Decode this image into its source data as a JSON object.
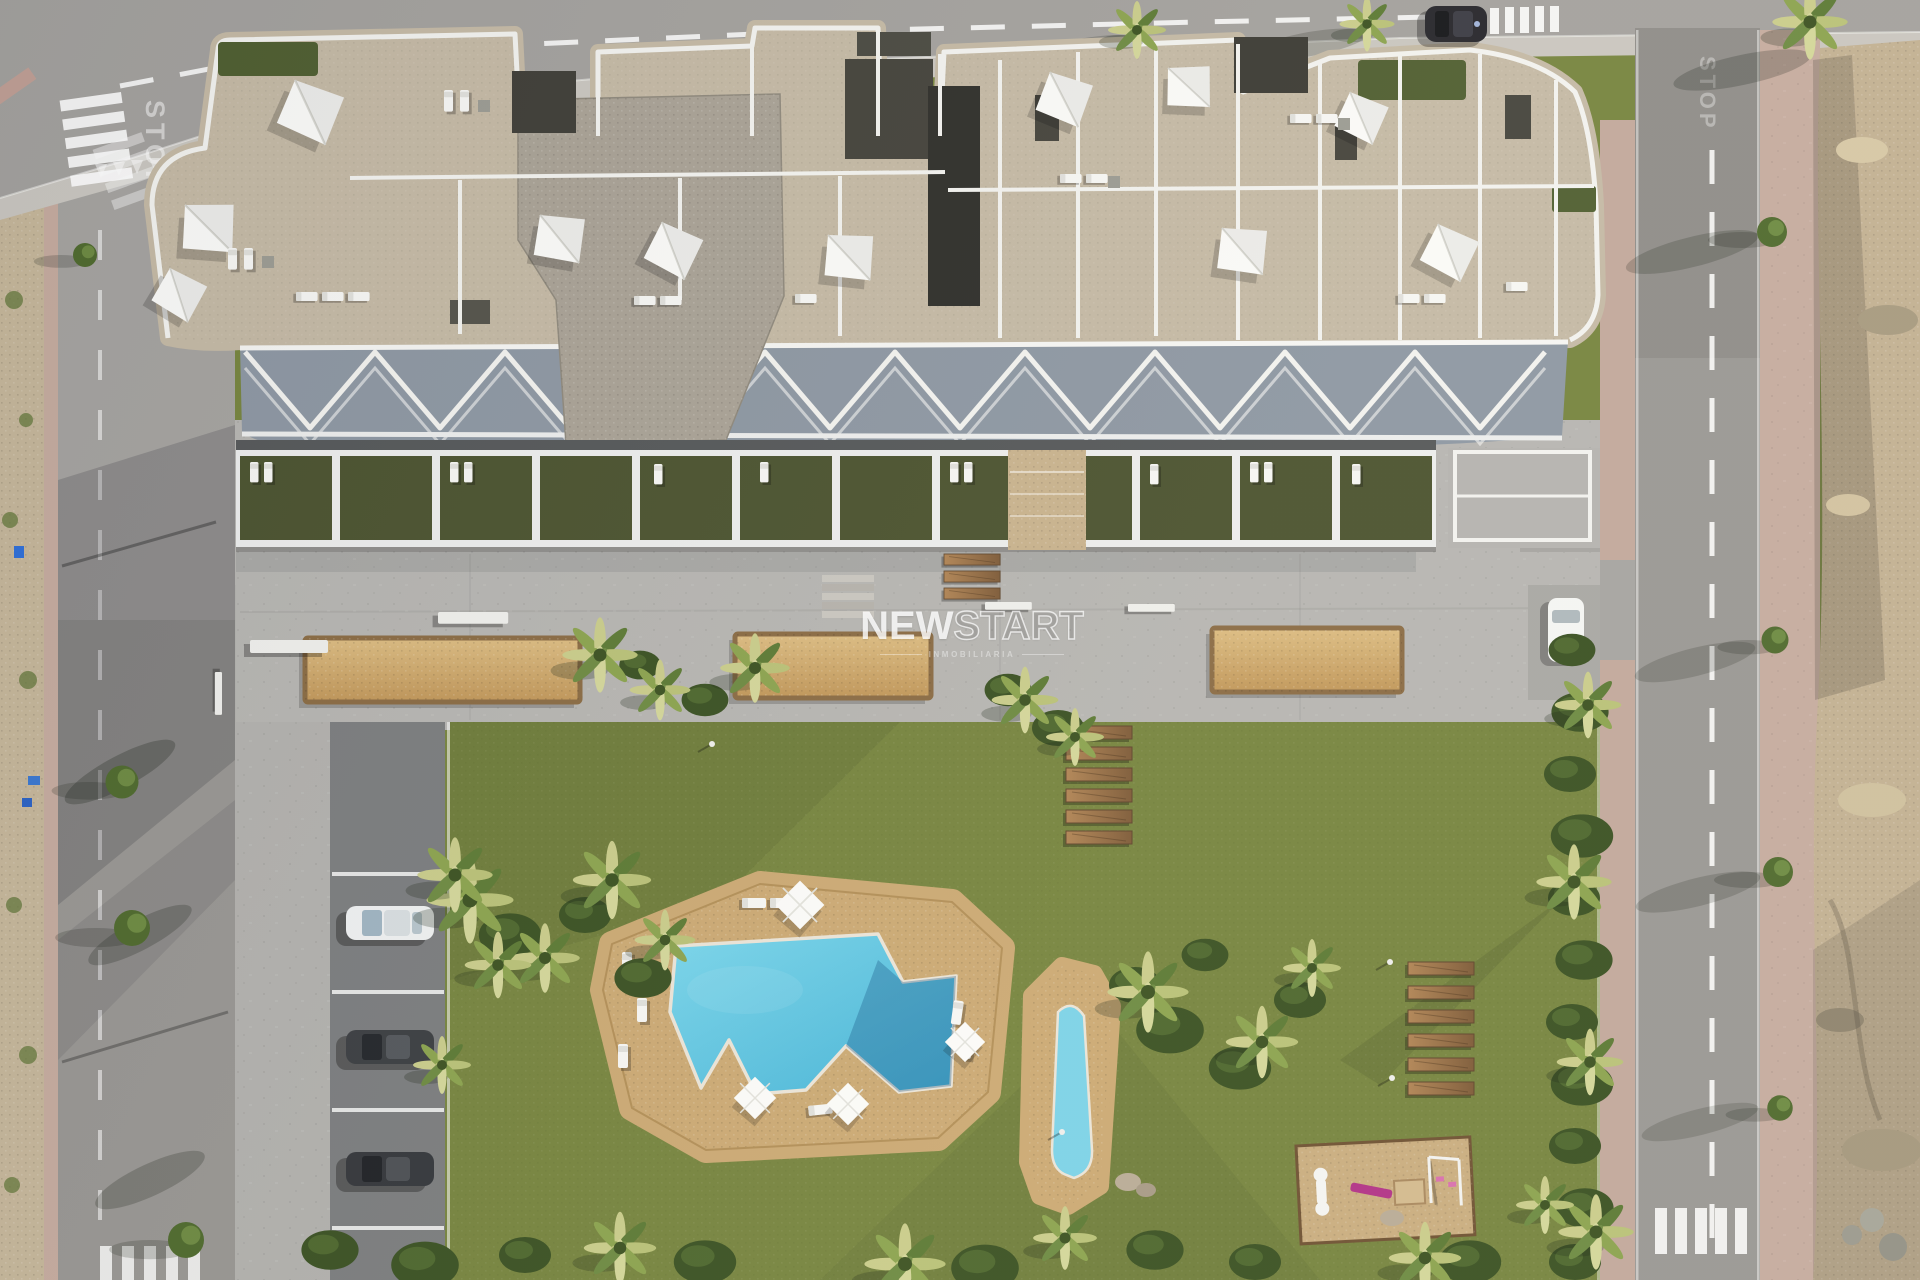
{
  "watermark": {
    "brand_bold": "NEW",
    "brand_outline": "START",
    "tagline": "INMOBILIARIA"
  },
  "road_markings": {
    "stop_left": "STOP",
    "stop_right": "STOP"
  },
  "palette": {
    "road": "#a3a19e",
    "road_dark": "#8f8d8a",
    "sidewalk": "#c9c6c0",
    "sidewalk_pink": "#c5ab9f",
    "dirt_lot": "#c2b093",
    "lawn": "#76843f",
    "terrace_lawn": "#4b5330",
    "promenade_concrete": "#b6b5b2",
    "planter_sand": "#d0ab6e",
    "pool_deck": "#cba974",
    "pool_water": "#5ec8e4",
    "pool_water_shaded": "#379fc6",
    "roof_stone": "#c4b9a5",
    "roof_gravel": "#a9a296",
    "roof_dark": "#3f3e38",
    "building_white": "#f2f2ef",
    "palm_light": "#c9cc8b",
    "palm_dark": "#41582a",
    "wood": "#a97c52",
    "playground_sand": "#c9ad80",
    "playground_pink": "#b13387"
  },
  "scene": {
    "view": "aerial top-down render of apartment complex with communal garden",
    "planter_count": 3,
    "garden_step_planks": 6,
    "sun_deck_planks": 6,
    "pools": [
      "main-pool",
      "kids-pool"
    ],
    "parked_cars_lot": [
      "white",
      "dark-gray",
      "dark-gray"
    ],
    "parked_cars_street": [
      "dark-suv",
      "white"
    ],
    "playground_items": [
      "seesaw",
      "slide",
      "sandbox",
      "swing-set"
    ]
  }
}
